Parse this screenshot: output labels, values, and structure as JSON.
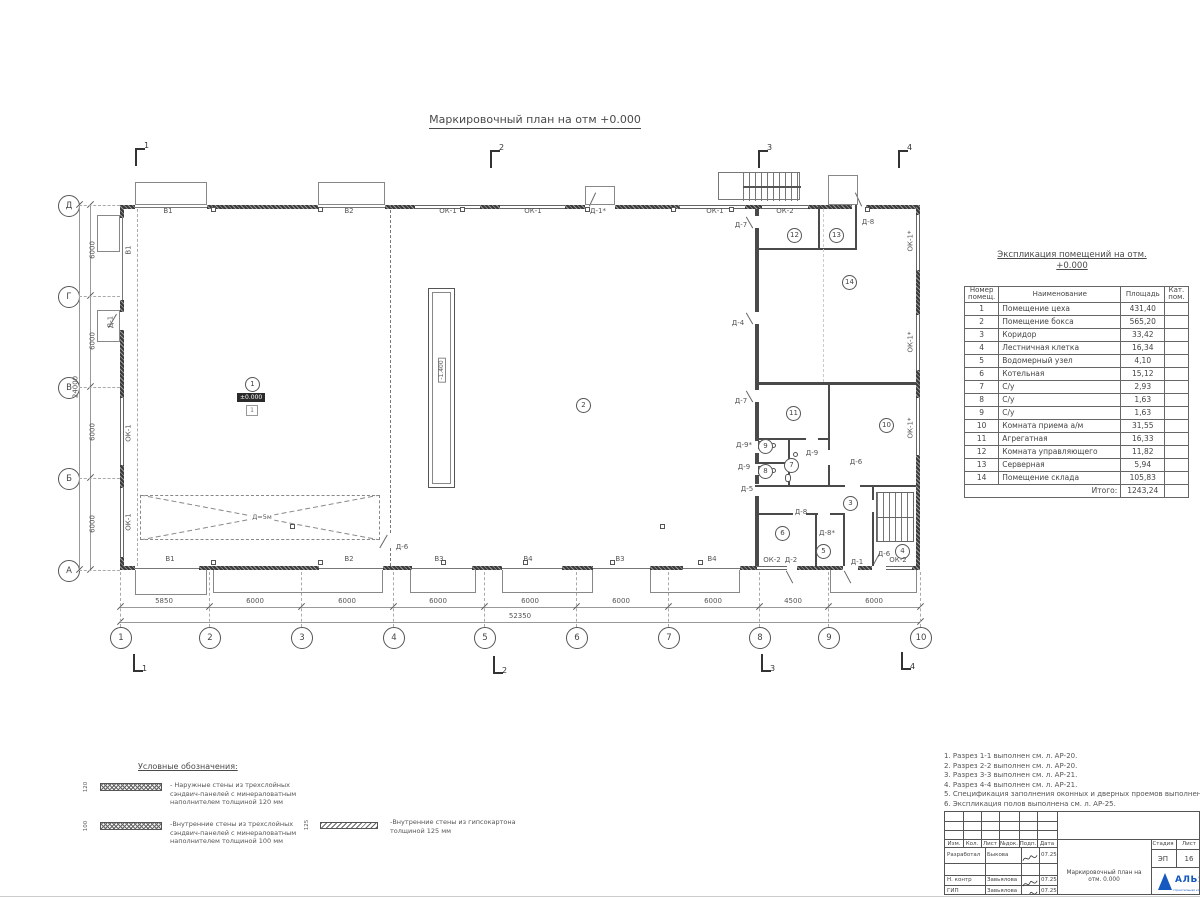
{
  "sheet": {
    "title": "Маркировочный план на отм +0.000"
  },
  "plan": {
    "grid_rows": [
      "Д",
      "Г",
      "В",
      "Б",
      "А"
    ],
    "grid_cols": [
      "1",
      "2",
      "3",
      "4",
      "5",
      "6",
      "7",
      "8",
      "9",
      "10"
    ],
    "dims_bottom": [
      "5850",
      "6000",
      "6000",
      "6000",
      "6000",
      "6000",
      "6000",
      "4500",
      "6000"
    ],
    "dim_total_bottom": "52350",
    "dims_left": [
      "6000",
      "6000",
      "6000",
      "6000"
    ],
    "dim_total_left": "24000",
    "sections_top": [
      "1",
      "2",
      "3",
      "4"
    ],
    "sections_bottom": [
      "1",
      "2",
      "3",
      "4"
    ],
    "rooms": [
      "1",
      "2",
      "3",
      "4",
      "5",
      "6",
      "7",
      "8",
      "9",
      "10",
      "11",
      "12",
      "13",
      "14"
    ],
    "level_mark": "±0.000",
    "level_tag": "1",
    "pit_level": "-1.400",
    "pit_width_label": "Д=5м",
    "labels_top": [
      "В1",
      "В2",
      "ОК-1",
      "ОК-1",
      "Д-1*",
      "ОК-1",
      "ОК-2",
      "Д-8"
    ],
    "labels_bottom": [
      "В1",
      "В2",
      "В3",
      "В4",
      "В3",
      "В4",
      "ОК-2",
      "Д-2",
      "Д-1",
      "Д-6",
      "ОК-2"
    ],
    "labels_left": [
      "В1",
      "Д-1",
      "ОК-1",
      "ОК-1"
    ],
    "labels_right": [
      "ОК-1*",
      "ОК-1*",
      "ОК-1*"
    ],
    "labels_interior": [
      "Д-7",
      "Д-4",
      "Д-7",
      "Д-9*",
      "Д-9",
      "Д-5",
      "Д-9",
      "Д-6",
      "Д-8",
      "Д-8*",
      "Д-6"
    ]
  },
  "explication": {
    "title": "Экспликация помещений на отм.\n+0.000",
    "headers": {
      "num": "Номер\nпомещ.",
      "name": "Наименование",
      "area": "Площадь",
      "cat": "Кат.\nпом."
    },
    "rows": [
      {
        "n": "1",
        "name": "Помещение цеха",
        "area": "431,40"
      },
      {
        "n": "2",
        "name": "Помещение бокса",
        "area": "565,20"
      },
      {
        "n": "3",
        "name": "Коридор",
        "area": "33,42"
      },
      {
        "n": "4",
        "name": "Лестничная клетка",
        "area": "16,34"
      },
      {
        "n": "5",
        "name": "Водомерный узел",
        "area": "4,10"
      },
      {
        "n": "6",
        "name": "Котельная",
        "area": "15,12"
      },
      {
        "n": "7",
        "name": "С/у",
        "area": "2,93"
      },
      {
        "n": "8",
        "name": "С/у",
        "area": "1,63"
      },
      {
        "n": "9",
        "name": "С/у",
        "area": "1,63"
      },
      {
        "n": "10",
        "name": "Комната приема а/м",
        "area": "31,55"
      },
      {
        "n": "11",
        "name": "Агрегатная",
        "area": "16,33"
      },
      {
        "n": "12",
        "name": "Комната управляющего",
        "area": "11,82"
      },
      {
        "n": "13",
        "name": "Серверная",
        "area": "5,94"
      },
      {
        "n": "14",
        "name": "Помещение склада",
        "area": "105,83"
      }
    ],
    "total_label": "Итого:",
    "total_value": "1243,24"
  },
  "notes": {
    "items": [
      "1. Разрез 1-1 выполнен см. л. АР-20.",
      "2. Разрез 2-2 выполнен см. л. АР-20.",
      "3. Разрез 3-3 выполнен см. л. АР-21.",
      "4. Разрез 4-4 выполнен см. л. АР-21.",
      "5. Спецификация заполнения оконных и дверных проемов выполнена см. л. АР-23, АР-24.",
      "6. Экспликация полов выполнена см. л. АР-25."
    ]
  },
  "legend": {
    "title": "Условные обозначения:",
    "items": [
      {
        "dim": "120",
        "text": "- Наружные стены из трехслойных\nсэндвич-панелей с минераловатным\nнаполнителем толщиной 120 мм"
      },
      {
        "dim": "100",
        "text": "-Внутренние стены из трехслойных\nсэндвич-панелей с минераловатным\nнаполнителем толщиной 100 мм"
      },
      {
        "dim": "125",
        "text": "-Внутренние стены из гипсокартона\nтолщиной 125 мм"
      }
    ]
  },
  "titleblock": {
    "header_cols": [
      "Изм.",
      "Кол.",
      "Лист",
      "№док.",
      "Подп.",
      "Дата"
    ],
    "rows": [
      {
        "role": "Разработал",
        "name": "Быкова",
        "date": "07.25"
      },
      {
        "role": "Н. контр",
        "name": "Завьялова",
        "date": "07.25"
      },
      {
        "role": "ГИП",
        "name": "Завьялова",
        "date": "07.25"
      }
    ],
    "doc_title": "Маркировочный план на отм. 0.000",
    "stage_label": "Стадия",
    "sheet_label": "Лист",
    "stage": "ЭП",
    "sheet_no": "16",
    "company": "АЛЬЯ",
    "company_sub": "строительная компания"
  }
}
